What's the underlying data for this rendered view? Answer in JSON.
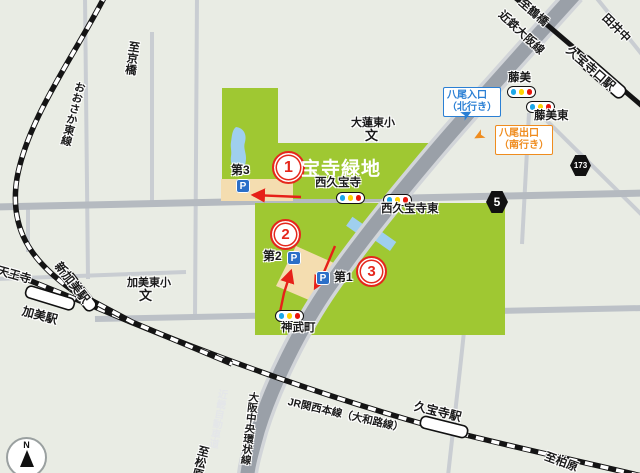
{
  "park": {
    "name_label": "宝寺緑地",
    "area_markers": {
      "m1": "1",
      "m2": "2",
      "m3": "3"
    }
  },
  "parkings": {
    "p1": "第1",
    "p2": "第2",
    "p3": "第3",
    "p_icon": "P"
  },
  "intersections": {
    "nishikyuhoji": "西久宝寺",
    "nishikyuhoji_higashi": "西久宝寺東",
    "jinmucho": "神武町",
    "fujimi": "藤美",
    "fujimi_higashi": "藤美東"
  },
  "signs": {
    "yao_entrance": {
      "line1": "八尾入口",
      "line2": "（北行き）",
      "arrow": "➤"
    },
    "yao_exit": {
      "line1": "八尾出口",
      "line2": "（南行き）",
      "arrow": "➤"
    }
  },
  "route_markers": {
    "r5": "5",
    "r173": "173"
  },
  "schools": {
    "ohasu_higashi": {
      "name": "大蓮東小",
      "symbol": "文"
    },
    "kami_higashi": {
      "name": "加美東小",
      "symbol": "文"
    }
  },
  "rail": {
    "to_kyobashi": "至京橋",
    "osaka_higashi_line": "おおさか東線",
    "to_tennoji": "至天王寺",
    "shinkami_station": "新加美駅",
    "kami_station": "加美駅",
    "to_tsuruhashi": "至鶴橋",
    "kintetsu_osaka_line": "近鉄大阪線",
    "kyuhojiguchi_station": "久宝寺口駅",
    "jr_kansai_line": "JR関西本線（大和路線）",
    "kyuhoji_station": "久宝寺駅",
    "to_kashiwara": "至柏原"
  },
  "roads": {
    "chuo_kanjo": "大阪中央環状線",
    "kinki_expwy": "近畿自動車道",
    "to_matsubara": "至松原",
    "tainaka": "田井中"
  },
  "compass": {
    "north": "N"
  },
  "colors": {
    "background": "#e9ece4",
    "park_green": "#9fc832",
    "pond_blue": "#9fcfee",
    "parking_beige": "#f4ddb0",
    "parking_blue": "#2b6fc8",
    "expressway_gray": "#9aa0a8",
    "signal_blue": "#1ba8e8",
    "signal_yellow": "#ffd400",
    "signal_red": "#e8160c",
    "marker_red": "#e5271c",
    "entrance_blue": "#2a7fd4",
    "exit_orange": "#ef8c1e",
    "route_arrow_red": "#e62019"
  }
}
